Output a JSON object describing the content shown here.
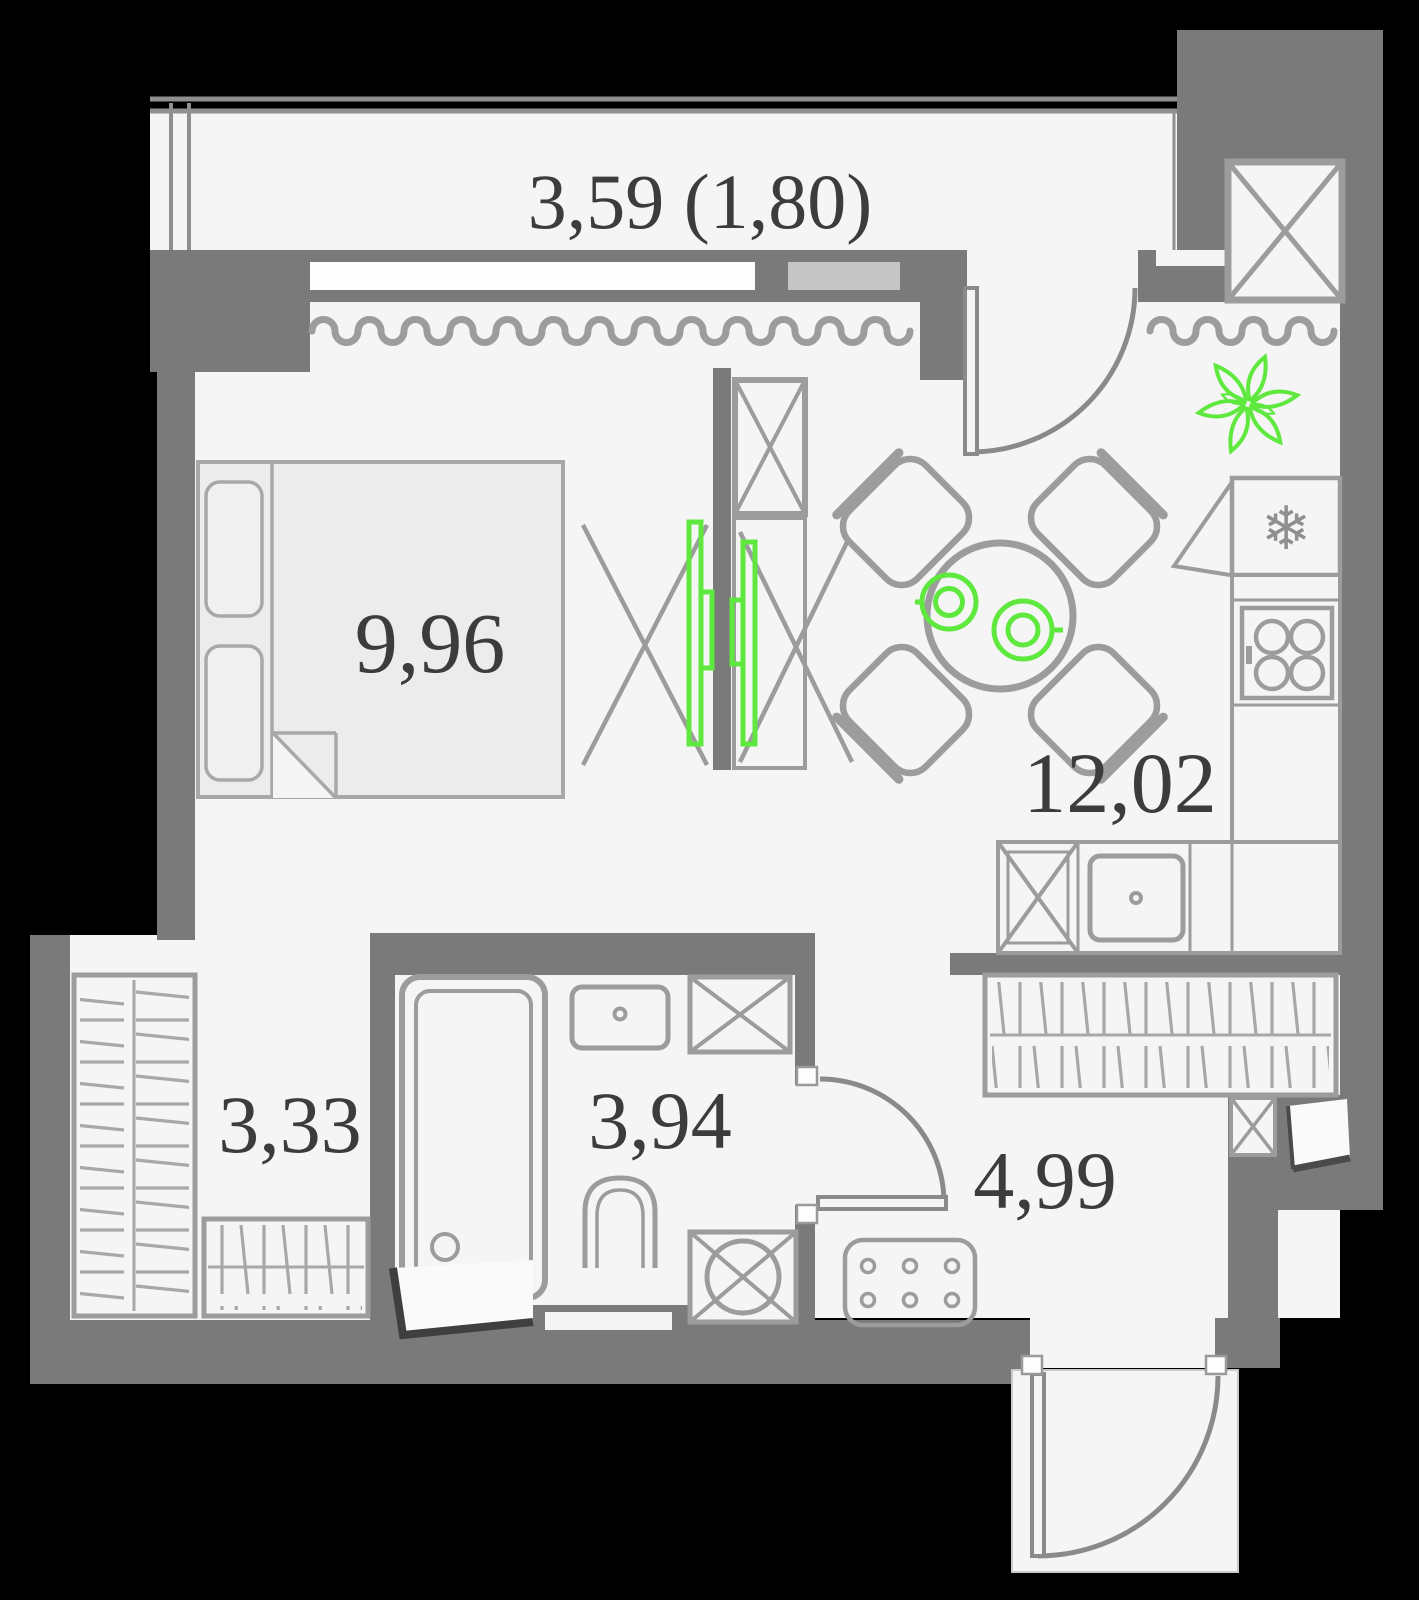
{
  "meta": {
    "title": "Studio apartment floor plan"
  },
  "rooms": {
    "balcony": {
      "label": "3,59 (1,80)"
    },
    "bedroom": {
      "label": "9,96"
    },
    "kitchen_living": {
      "label": "12,02"
    },
    "hallway": {
      "label": "3,33"
    },
    "bathroom": {
      "label": "3,94"
    },
    "corridor": {
      "label": "4,99"
    }
  },
  "icons": {
    "snowflake_glyph": "❄",
    "plant": "flower-outline",
    "plates": "two-place-settings",
    "tv": "green-tv-panels",
    "shaft": "crossed-box-vent"
  },
  "colors": {
    "background": "#000000",
    "wall": "#7a7a7a",
    "floor": "#f5f5f5",
    "furniture": "#9c9c9c",
    "window_glass": "#c6c6c6",
    "accent_green": "#5fe83e",
    "label_text": "#3c3c3c"
  }
}
